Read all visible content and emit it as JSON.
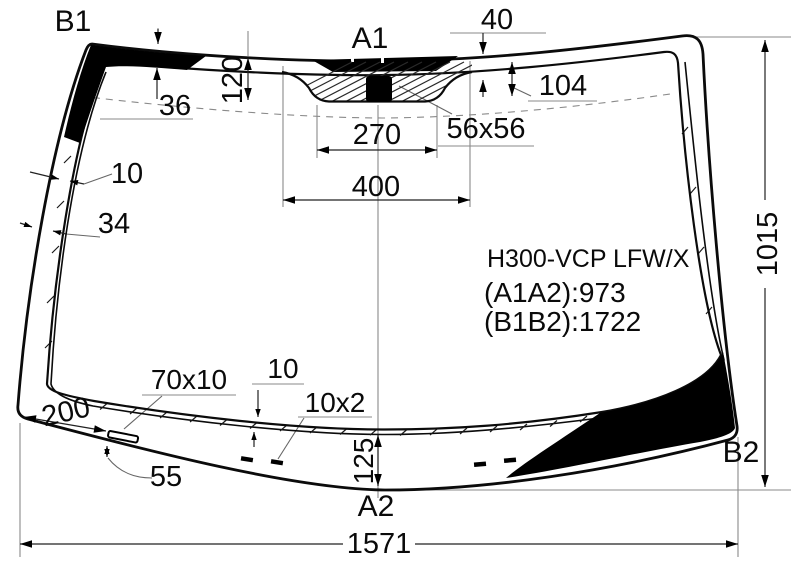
{
  "diagram": {
    "labels": {
      "top_left": "B1",
      "top_center": "A1",
      "bottom_center": "A2",
      "bottom_right": "B2"
    },
    "dims": {
      "d40": "40",
      "d104": "104",
      "d120": "120",
      "d36": "36",
      "d270": "270",
      "d400": "400",
      "d56x56": "56x56",
      "d10_left": "10",
      "d34": "34",
      "d1015": "1015",
      "d200": "200",
      "d70x10": "70x10",
      "d10_bottom": "10",
      "d10x2": "10x2",
      "d55": "55",
      "d125": "125",
      "d1571": "1571"
    },
    "info": {
      "model": "H300-VCP LFW/X",
      "a1a2": "(A1A2):973",
      "b1b2": "(B1B2):1722"
    },
    "colors": {
      "ink": "#000000",
      "background": "#ffffff",
      "construction": "#888888"
    }
  }
}
